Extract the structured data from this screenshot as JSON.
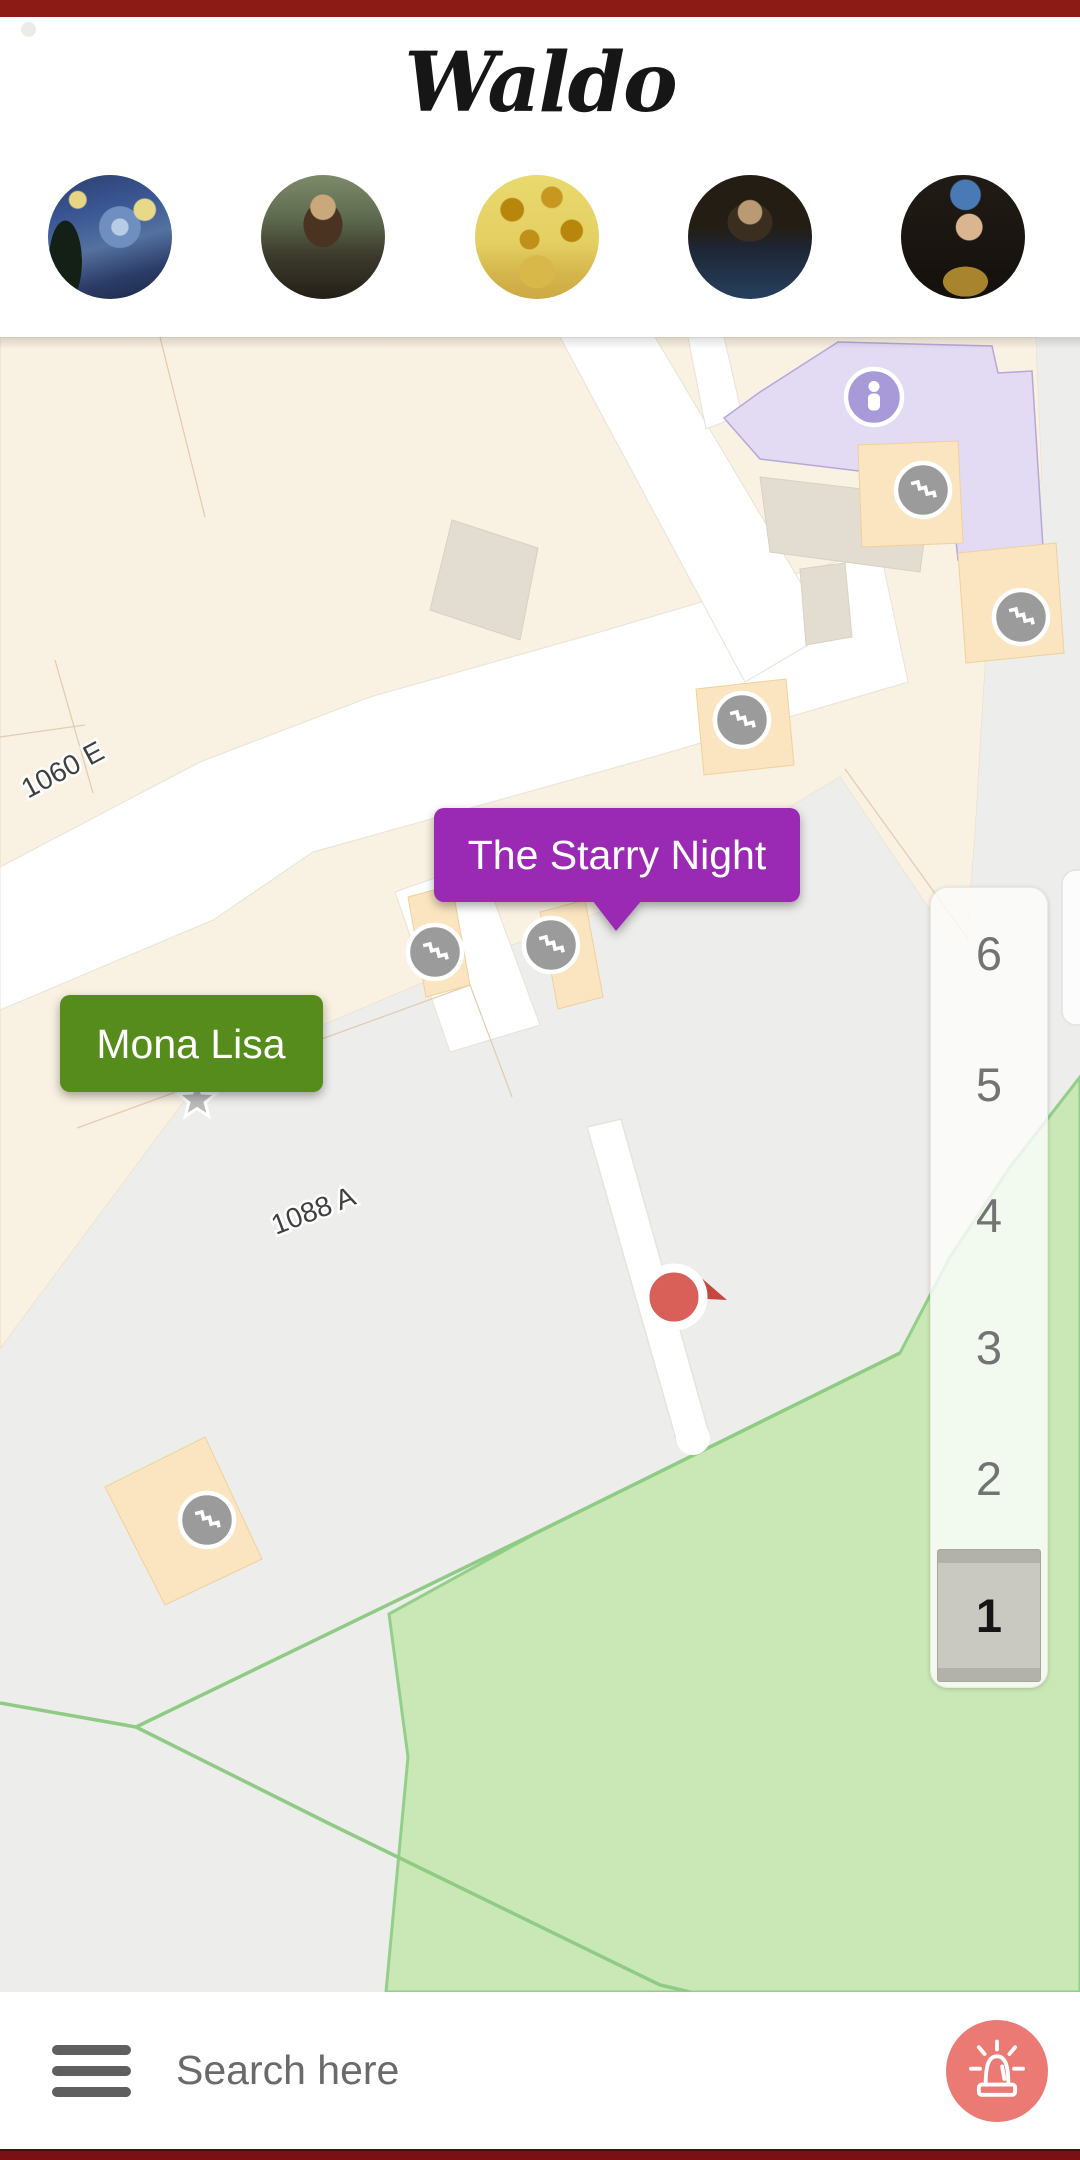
{
  "header": {
    "logo": "Waldo",
    "artworks": [
      {
        "id": "the-starry-night",
        "label": "The Starry Night"
      },
      {
        "id": "mona-lisa",
        "label": "Mona Lisa"
      },
      {
        "id": "sunflowers",
        "label": "Sunflowers"
      },
      {
        "id": "salvator-mundi",
        "label": "Salvator Mundi"
      },
      {
        "id": "girl-with-a-pearl-earring",
        "label": "Girl with a Pearl Earring"
      }
    ]
  },
  "map": {
    "room_labels": [
      {
        "text": "1060 E"
      },
      {
        "text": "1088 A"
      }
    ],
    "artwork_tooltips": [
      {
        "text": "The Starry Night",
        "color": "#9a2ab3"
      },
      {
        "text": "Mona Lisa",
        "color": "#578c1c"
      }
    ],
    "floor_selector": {
      "floors": [
        "6",
        "5",
        "4",
        "3",
        "2",
        "1"
      ],
      "selected": "1"
    },
    "marker_icons": [
      "stairs-icon",
      "information-person-icon",
      "current-location-icon",
      "star-icon"
    ],
    "colors": {
      "room_fill": "#f9f1e2",
      "plaza_fill": "#ededeb",
      "park_fill": "#c9e8b5",
      "park_line": "#8fcb85",
      "accessible_area_fill": "#e2dbf3",
      "stair_landing_fill": "#fbe5c1",
      "stairs_marker": "#9b9b9b",
      "info_marker": "#a89ad8",
      "location_dot": "#d95f59"
    }
  },
  "search_bar": {
    "placeholder": "Search here",
    "alarm_button_color": "#ec7a74"
  },
  "theme": {
    "top_bar_color": "#8c1b16",
    "bottom_bar_color": "#7a1013"
  }
}
